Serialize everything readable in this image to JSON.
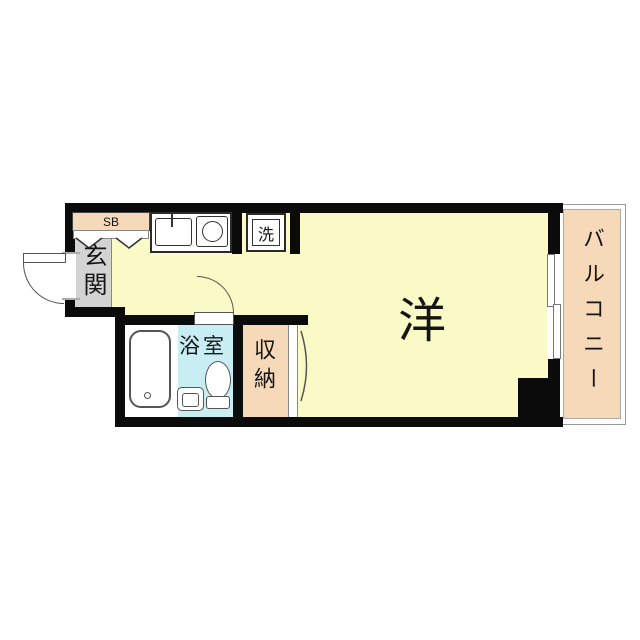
{
  "floorplan": {
    "labels": {
      "main_room": "洋",
      "entrance": "玄関",
      "shoe_box": "SB",
      "washing_machine": "洗",
      "bathroom": "浴室",
      "storage": "収納",
      "balcony": "バルコニー"
    },
    "colors": {
      "floor_yellow": "#FAFAC6",
      "accent_peach": "#F6D9B8",
      "entrance_gray": "#D3D3D3",
      "bathroom_blue": "#C8EDF3",
      "wall_black": "#0B0B0B",
      "background": "#FFFFFF"
    },
    "fixtures": [
      "entrance-door-swing",
      "shoe-box-step-zigzag",
      "kitchen-sink",
      "stove-burner",
      "washing-machine-space",
      "bathroom-door-swing",
      "bathtub",
      "toilet",
      "wash-basin",
      "storage-sliding-door",
      "balcony-window",
      "structural-pillar"
    ]
  }
}
